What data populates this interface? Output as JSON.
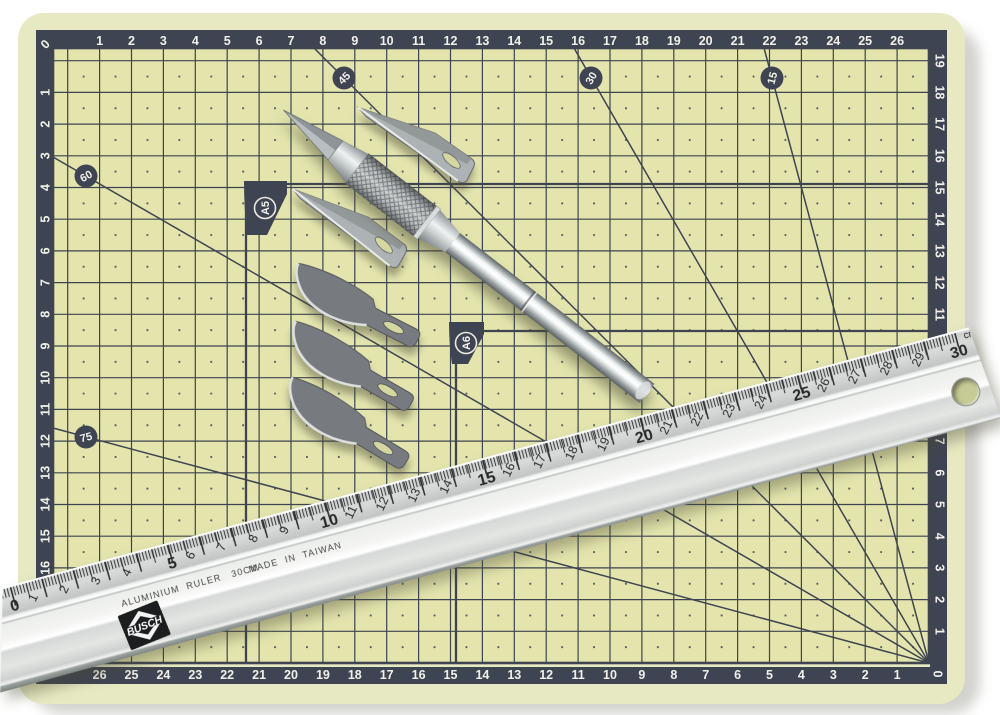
{
  "scene": {
    "description": "Self-healing cutting mat with hobby knife, spare blades and aluminium ruler",
    "background": "#ffffff"
  },
  "mat": {
    "colors": {
      "surface": "#e3e5ad",
      "margin": "#e7e9c2",
      "band": "#3f4452",
      "grid_line": "#3e4450",
      "number": "#f1f1e9"
    },
    "corner_zero_top_left": "0",
    "corner_zero_bottom_right": "0",
    "top_scale": [
      "1",
      "2",
      "3",
      "4",
      "5",
      "6",
      "7",
      "8",
      "9",
      "10",
      "11",
      "12",
      "13",
      "14",
      "15",
      "16",
      "17",
      "18",
      "19",
      "20",
      "21",
      "22",
      "23",
      "24",
      "25",
      "26"
    ],
    "bottom_scale": [
      "1",
      "2",
      "3",
      "4",
      "5",
      "6",
      "7",
      "8",
      "9",
      "10",
      "11",
      "12",
      "13",
      "14",
      "15",
      "16",
      "17",
      "18",
      "19",
      "20",
      "21",
      "22",
      "23",
      "24",
      "25",
      "26"
    ],
    "left_scale": [
      "1",
      "2",
      "3",
      "4",
      "5",
      "6",
      "7",
      "8",
      "9",
      "10",
      "11",
      "12",
      "13",
      "14",
      "15",
      "16",
      "17",
      "18"
    ],
    "right_scale": [
      "1",
      "2",
      "3",
      "4",
      "5",
      "6",
      "7",
      "8",
      "9",
      "10",
      "11",
      "12",
      "13",
      "14",
      "15",
      "16",
      "17",
      "18",
      "19"
    ],
    "angle_labels": [
      "45",
      "30",
      "15",
      "60",
      "75"
    ],
    "size_markers": [
      "A5",
      "A6"
    ]
  },
  "ruler": {
    "scale_numbers": [
      "0",
      "1",
      "2",
      "3",
      "4",
      "5",
      "6",
      "7",
      "8",
      "9",
      "10",
      "11",
      "12",
      "13",
      "14",
      "15",
      "16",
      "17",
      "18",
      "19",
      "20",
      "21",
      "22",
      "23",
      "24",
      "25",
      "26",
      "27",
      "28",
      "29",
      "30"
    ],
    "unit_label": "cm",
    "brand_line": "ALUMINIUM  RULER   30CM",
    "origin_line": "MADE  IN  TAIWAN",
    "logo_text": "BUSCH",
    "colors": {
      "body": "#e8eae8",
      "tick": "#2f3133"
    }
  }
}
